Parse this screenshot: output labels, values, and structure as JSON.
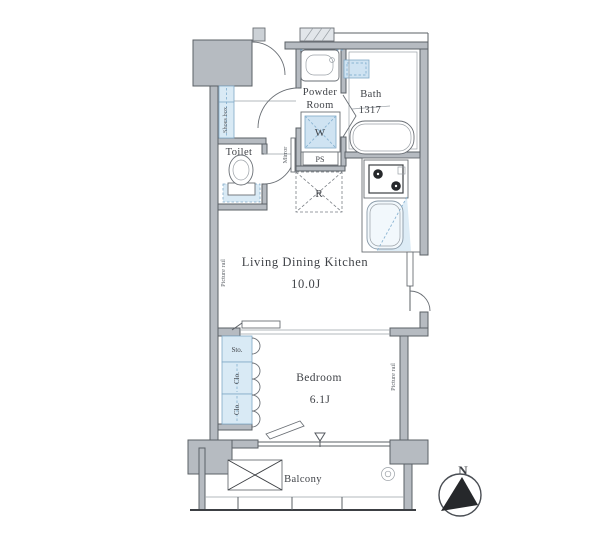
{
  "floorplan": {
    "rooms": {
      "entrance": "Entrance",
      "powder1": "Powder",
      "powder2": "Room",
      "bath": "Bath",
      "bath_size": "1317",
      "toilet": "Toilet",
      "ldk": "Living Dining Kitchen",
      "ldk_size": "10.0J",
      "bedroom": "Bedroom",
      "bedroom_size": "6.1J",
      "balcony": "Balcony"
    },
    "fixtures": {
      "washing_machine": "W",
      "pipe_space": "PS",
      "refrigerator": "R",
      "mirror": "Mirror",
      "shoes_box": "Shoes box",
      "storage": "Sto.",
      "closet_upper": "Clo.",
      "closet_lower": "Clo.",
      "picture_rail_left": "Picture rail",
      "picture_rail_right": "Picture rail"
    },
    "compass": {
      "north_label": "N"
    },
    "colors": {
      "wall_gray": "#b6bbc1",
      "outline": "#5b6066",
      "fixture_blue_fill": "#d9eaf5",
      "fixture_blue_stroke": "#7fa8c6",
      "text": "#3f4247",
      "north_arrow": "#26282b"
    }
  }
}
